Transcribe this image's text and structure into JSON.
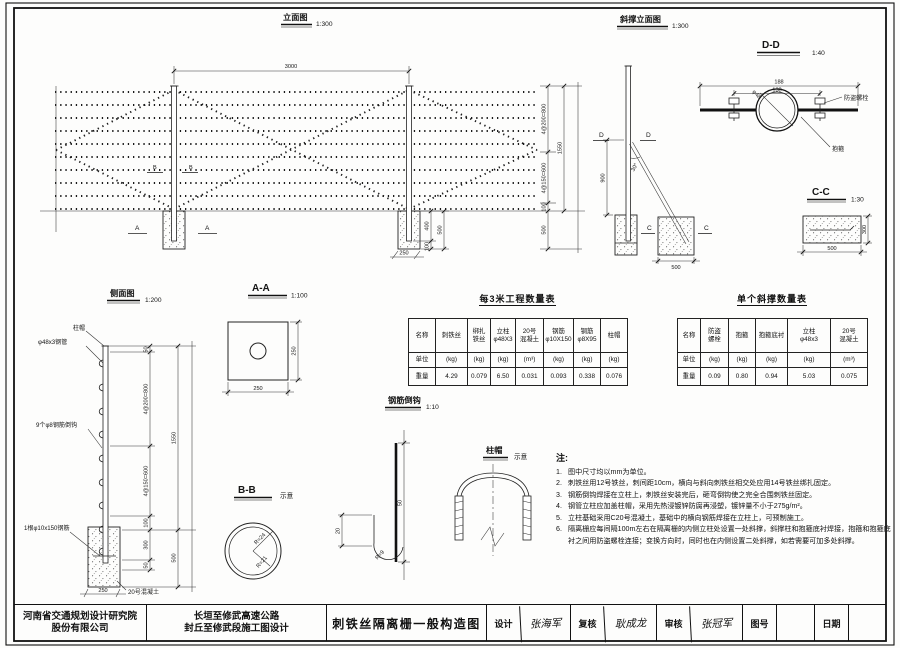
{
  "views": {
    "elevation": {
      "title": "立面图",
      "scale": "1:300"
    },
    "brace": {
      "title": "斜撑立面图",
      "scale": "1:300"
    },
    "dd": {
      "title": "D-D",
      "scale": "1:40"
    },
    "cc": {
      "title": "C-C",
      "scale": "1:30"
    },
    "side": {
      "title": "侧面图",
      "scale": "1:200"
    },
    "aa": {
      "title": "A-A",
      "scale": "1:100"
    },
    "bb": {
      "title": "B-B",
      "note": "示意"
    },
    "hook": {
      "title": "钢筋倒钩",
      "scale": "1:10"
    },
    "cap": {
      "title": "柱帽",
      "note": "示意"
    }
  },
  "elev": {
    "span": "3000",
    "a": "A",
    "b": "B",
    "c800": "4@200=800",
    "c600": "4@150=600",
    "c100": "100",
    "c500": "500",
    "c1550": "1550",
    "f400": "400",
    "f500": "500",
    "f100": "100",
    "f250": "250"
  },
  "brace": {
    "d": "D",
    "c": "C",
    "angle": "30°",
    "h900": "900",
    "w500": "500"
  },
  "dd": {
    "w188": "188",
    "w138": "138",
    "dia": "φ48",
    "bolt": "防盗螺栓",
    "clamp": "抱箍"
  },
  "cc": {
    "w500": "500",
    "h300": "300"
  },
  "side": {
    "cap": "柱帽",
    "pipe": "φ48x3钢管",
    "hooks": "9个φ8钢筋倒钩",
    "rebar": "1根φ10x150钢筋",
    "concrete": "20号混凝土",
    "d50a": "50",
    "c800": "4@200=800",
    "c600": "4@150=600",
    "c100": "100",
    "c300": "300",
    "d50b": "50",
    "c1550": "1550",
    "c500": "500",
    "c250": "250"
  },
  "aa": {
    "d250r": "250",
    "d250b": "250"
  },
  "bb": {
    "r24": "R=24",
    "r21": "R=21"
  },
  "hook": {
    "d50": "50",
    "d20": "20",
    "r9": "R=9"
  },
  "table1": {
    "title": "每3米工程数量表",
    "header": [
      "名称",
      "刺铁丝",
      "绑扎\n铁丝",
      "立柱\nφ48X3",
      "20号\n混凝土",
      "钢筋\nφ10X150",
      "钢筋\nφ8X95",
      "柱帽"
    ],
    "units": [
      "单位",
      "(kg)",
      "(kg)",
      "(kg)",
      "(m³)",
      "(kg)",
      "(kg)",
      "(kg)"
    ],
    "values": [
      "重量",
      "4.29",
      "0.079",
      "6.50",
      "0.031",
      "0.093",
      "0.338",
      "0.076"
    ]
  },
  "table2": {
    "title": "单个斜撑数量表",
    "header": [
      "名称",
      "防盗\n螺栓",
      "抱箍",
      "抱箍底衬",
      "立柱\nφ48x3",
      "20号\n混凝土"
    ],
    "units": [
      "单位",
      "(kg)",
      "(kg)",
      "(kg)",
      "(kg)",
      "(m³)"
    ],
    "values": [
      "重量",
      "0.09",
      "0.80",
      "0.94",
      "5.03",
      "0.075"
    ]
  },
  "notes": {
    "title": "注:",
    "items": [
      {
        "n": "1.",
        "t": "图中尺寸均以mm为单位。"
      },
      {
        "n": "2.",
        "t": "刺铁丝用12号铁丝，刺间距10cm，横向与斜向刺铁丝相交处应用14号铁丝绑扎固定。"
      },
      {
        "n": "3.",
        "t": "钢筋倒钩焊接在立柱上，刺铁丝安装完后，砸弯倒钩使之完全合围刺铁丝固定。"
      },
      {
        "n": "4.",
        "t": "钢管立柱应加盖柱帽，采用先热浸镀锌防腐再浸塑，镀锌量不小于275g/m²。"
      },
      {
        "n": "5.",
        "t": "立柱基础采用C20号混凝土，基础中的横向钢筋焊接在立柱上，可预制施工。"
      },
      {
        "n": "6.",
        "t": "隔离栅应每间隔100m左右在隔离栅的内侧立柱处设置一处斜撑，斜撑柱和抱箍底衬焊接，抱箍和抱箍底衬之间用防盗螺栓连接；变换方向时，同时也在内侧设置二处斜撑，如若需要可加多处斜撑。"
      }
    ]
  },
  "titleblock": {
    "company": "河南省交通规划设计研究院\n股份有限公司",
    "project": "长垣至修武高速公路\n封丘至修武段施工图设计",
    "drawing_title": "刺铁丝隔离栅一般构造图",
    "design_label": "设计",
    "design_name": "张海军",
    "check_label": "复核",
    "check_name": "耿成龙",
    "review_label": "审核",
    "review_name": "张冠军",
    "figno_label": "图号",
    "figno_value": "",
    "date_label": "日期",
    "date_value": ""
  }
}
